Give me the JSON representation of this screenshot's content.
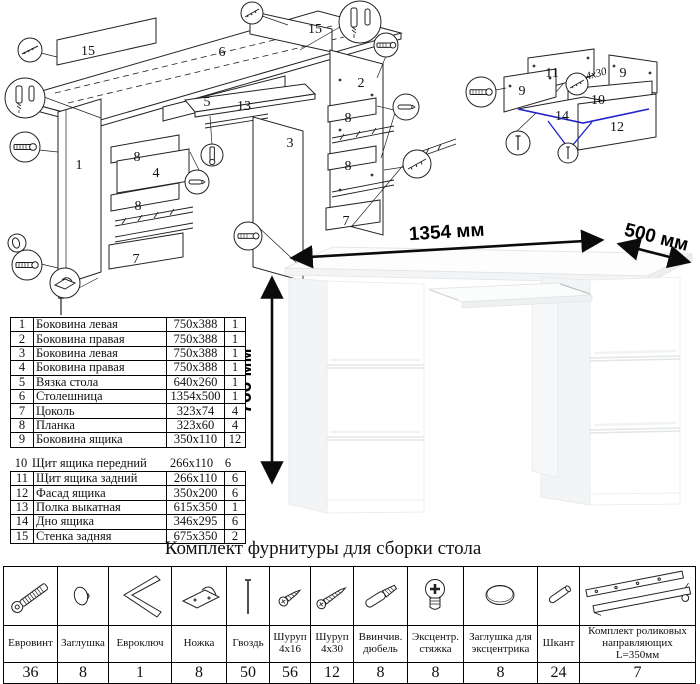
{
  "colors": {
    "line": "#1a1a1a",
    "highlight_blue": "#2222cc"
  },
  "assembly": {
    "labels": {
      "p15a": "15",
      "p6": "6",
      "p15b": "15",
      "p5": "5",
      "p13": "13",
      "p2": "2",
      "p3": "3",
      "p1": "1",
      "p8a": "8",
      "p4": "4",
      "p8b": "8",
      "p7a": "7",
      "p8c": "8",
      "p8d": "8",
      "p7b": "7"
    }
  },
  "drawer_detail": {
    "labels": {
      "p11": "11",
      "p9a": "9",
      "p9b": "9",
      "p10": "10",
      "p14": "14",
      "p12": "12"
    },
    "screw_note": "4x30"
  },
  "desk_photo": {
    "width_label": "1354 мм",
    "depth_label": "500 мм",
    "height_label": "766 мм"
  },
  "parts_table": {
    "rows": [
      {
        "num": "1",
        "name": "Боковина левая",
        "size": "750x388",
        "qty": "1"
      },
      {
        "num": "2",
        "name": "Боковина правая",
        "size": "750x388",
        "qty": "1"
      },
      {
        "num": "3",
        "name": "Боковина левая",
        "size": "750x388",
        "qty": "1"
      },
      {
        "num": "4",
        "name": "Боковина правая",
        "size": "750x388",
        "qty": "1"
      },
      {
        "num": "5",
        "name": "Вязка стола",
        "size": "640x260",
        "qty": "1"
      },
      {
        "num": "6",
        "name": "Столешница",
        "size": "1354x500",
        "qty": "1"
      },
      {
        "num": "7",
        "name": "Цоколь",
        "size": "323x74",
        "qty": "4"
      },
      {
        "num": "8",
        "name": "Планка",
        "size": "323x60",
        "qty": "4"
      },
      {
        "num": "9",
        "name": "Боковина ящика",
        "size": "350x110",
        "qty": "12"
      },
      {
        "num": "10",
        "name": "Щит ящика передний",
        "size": "266x110",
        "qty": "6"
      },
      {
        "num": "11",
        "name": "Щит ящика задний",
        "size": "266x110",
        "qty": "6"
      },
      {
        "num": "12",
        "name": "Фасад ящика",
        "size": "350x200",
        "qty": "6"
      },
      {
        "num": "13",
        "name": "Полка выкатная",
        "size": "615x350",
        "qty": "1"
      },
      {
        "num": "14",
        "name": "Дно ящика",
        "size": "346x295",
        "qty": "6"
      },
      {
        "num": "15",
        "name": "Стенка задняя",
        "size": "675x350",
        "qty": "2"
      }
    ]
  },
  "hardware_kit": {
    "title": "Комплект фурнитуры для сборки стола",
    "items": [
      {
        "name": "Евровинт",
        "qty": "36"
      },
      {
        "name": "Заглушка",
        "qty": "8"
      },
      {
        "name": "Евроключ",
        "qty": "1"
      },
      {
        "name": "Ножка",
        "qty": "8"
      },
      {
        "name": "Гвоздь",
        "qty": "50"
      },
      {
        "name": "Шуруп 4x16",
        "qty": "56"
      },
      {
        "name": "Шуруп 4x30",
        "qty": "12"
      },
      {
        "name": "Ввинчив. дюбель",
        "qty": "8"
      },
      {
        "name": "Эксцентр. стяжка",
        "qty": "8"
      },
      {
        "name": "Заглушка для эксцентрика",
        "qty": "8"
      },
      {
        "name": "Шкант",
        "qty": "24"
      },
      {
        "name": "Комплект роликовых направляющих L=350мм",
        "qty": "7"
      }
    ]
  }
}
